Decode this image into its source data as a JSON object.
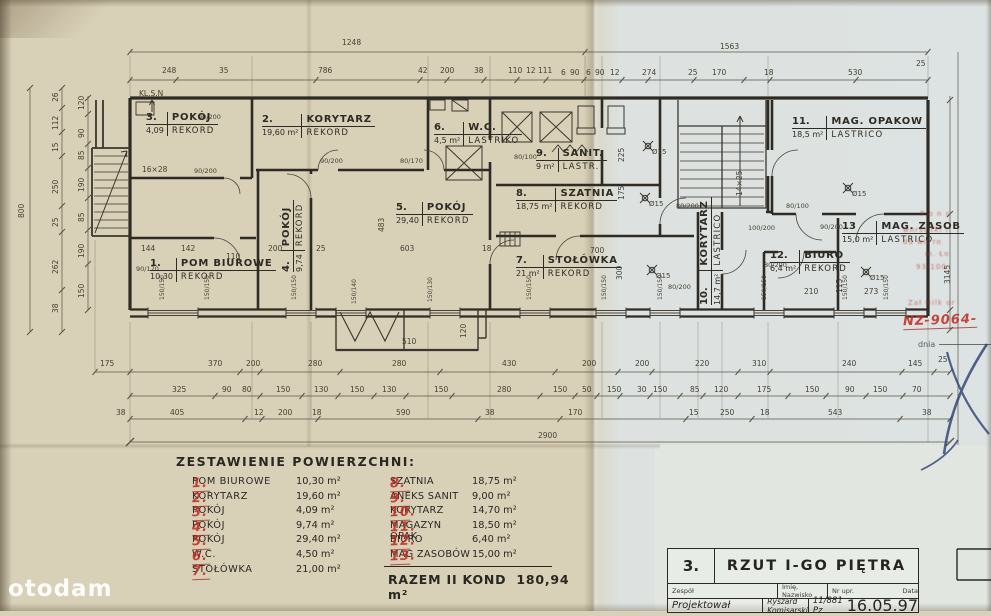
{
  "watermark": "otodam",
  "colors": {
    "paper_left": "#d9d0b8",
    "paper_right": "#dde3e2",
    "ink": "#2e2b25",
    "dim_ink": "#55514a",
    "stamp_red": "#b23426",
    "pen_blue": "#2e3f72"
  },
  "plan": {
    "rooms": [
      {
        "num": "1.",
        "name": "POM BIUROWE",
        "area": "10,30",
        "floor": "REKORD",
        "x": 150,
        "y": 258
      },
      {
        "num": "2.",
        "name": "KORYTARZ",
        "area": "19,60 m²",
        "floor": "REKORD",
        "x": 262,
        "y": 114
      },
      {
        "num": "3.",
        "name": "POKÓJ",
        "area": "4,09",
        "floor": "REKORD",
        "x": 146,
        "y": 112
      },
      {
        "num": "4.",
        "name": "POKÓJ",
        "area": "9,74",
        "floor": "REKORD",
        "x": 281,
        "y": 272,
        "c": "vert"
      },
      {
        "num": "5.",
        "name": "POKÓJ",
        "area": "29,40",
        "floor": "REKORD",
        "x": 396,
        "y": 202
      },
      {
        "num": "6.",
        "name": "W.C.",
        "area": "4,5 m²",
        "floor": "LASTRIKO",
        "x": 434,
        "y": 122
      },
      {
        "num": "7.",
        "name": "STOŁÓWKA",
        "area": "21 m²",
        "floor": "REKORD",
        "x": 516,
        "y": 255
      },
      {
        "num": "8.",
        "name": "SZATNIA",
        "area": "18,75 m²",
        "floor": "REKORD",
        "x": 516,
        "y": 188
      },
      {
        "num": "9.",
        "name": "SANIT.",
        "area": "9 m²",
        "floor": "LASTR.",
        "x": 536,
        "y": 148
      },
      {
        "num": "10.",
        "name": "KORYTARZ",
        "area": "14,7 m²",
        "floor": "LASTRICO",
        "x": 699,
        "y": 305,
        "c": "vert"
      },
      {
        "num": "11.",
        "name": "MAG. OPAKOW",
        "area": "18,5 m²",
        "floor": "LASTRICO",
        "x": 792,
        "y": 116
      },
      {
        "num": "12.",
        "name": "BIURO",
        "area": "6,4 m²",
        "floor": "REKORD",
        "x": 770,
        "y": 250
      },
      {
        "num": "13",
        "name": "MAG. ZASOB",
        "area": "15,0 m²",
        "floor": "LASTRICO",
        "x": 842,
        "y": 221
      }
    ],
    "annotations": [
      {
        "t": "1248",
        "x": 342,
        "y": 39,
        "c": "d"
      },
      {
        "t": "1563",
        "x": 720,
        "y": 43,
        "c": "d"
      },
      {
        "t": "248",
        "x": 162,
        "y": 67,
        "c": "d"
      },
      {
        "t": "35",
        "x": 219,
        "y": 67,
        "c": "d"
      },
      {
        "t": "786",
        "x": 318,
        "y": 67,
        "c": "d"
      },
      {
        "t": "42",
        "x": 418,
        "y": 67,
        "c": "d"
      },
      {
        "t": "200",
        "x": 440,
        "y": 67,
        "c": "d"
      },
      {
        "t": "38",
        "x": 474,
        "y": 67,
        "c": "d"
      },
      {
        "t": "110",
        "x": 508,
        "y": 67,
        "c": "d"
      },
      {
        "t": "12",
        "x": 526,
        "y": 67,
        "c": "d"
      },
      {
        "t": "111",
        "x": 538,
        "y": 67,
        "c": "d"
      },
      {
        "t": "6",
        "x": 561,
        "y": 69,
        "c": "d"
      },
      {
        "t": "90",
        "x": 570,
        "y": 69,
        "c": "d"
      },
      {
        "t": "6",
        "x": 586,
        "y": 69,
        "c": "d"
      },
      {
        "t": "90",
        "x": 595,
        "y": 69,
        "c": "d"
      },
      {
        "t": "12",
        "x": 610,
        "y": 69,
        "c": "d"
      },
      {
        "t": "274",
        "x": 642,
        "y": 69,
        "c": "d"
      },
      {
        "t": "25",
        "x": 688,
        "y": 69,
        "c": "d"
      },
      {
        "t": "170",
        "x": 712,
        "y": 69,
        "c": "d"
      },
      {
        "t": "18",
        "x": 764,
        "y": 69,
        "c": "d"
      },
      {
        "t": "530",
        "x": 848,
        "y": 69,
        "c": "d"
      },
      {
        "t": "25",
        "x": 916,
        "y": 60,
        "c": "d"
      },
      {
        "t": "800",
        "x": 18,
        "y": 218,
        "c": "r"
      },
      {
        "t": "26",
        "x": 52,
        "y": 102,
        "c": "r"
      },
      {
        "t": "112",
        "x": 52,
        "y": 130,
        "c": "r"
      },
      {
        "t": "15",
        "x": 52,
        "y": 152,
        "c": "r"
      },
      {
        "t": "250",
        "x": 52,
        "y": 194,
        "c": "r"
      },
      {
        "t": "25",
        "x": 52,
        "y": 227,
        "c": "r"
      },
      {
        "t": "262",
        "x": 52,
        "y": 274,
        "c": "r"
      },
      {
        "t": "38",
        "x": 52,
        "y": 313,
        "c": "r"
      },
      {
        "t": "120",
        "x": 78,
        "y": 110,
        "c": "r"
      },
      {
        "t": "90",
        "x": 78,
        "y": 138,
        "c": "r"
      },
      {
        "t": "85",
        "x": 78,
        "y": 160,
        "c": "r"
      },
      {
        "t": "190",
        "x": 78,
        "y": 192,
        "c": "r"
      },
      {
        "t": "85",
        "x": 78,
        "y": 222,
        "c": "r"
      },
      {
        "t": "190",
        "x": 78,
        "y": 258,
        "c": "r"
      },
      {
        "t": "150",
        "x": 78,
        "y": 298,
        "c": "r"
      },
      {
        "t": "175",
        "x": 100,
        "y": 360,
        "c": "d"
      },
      {
        "t": "370",
        "x": 208,
        "y": 360,
        "c": "d"
      },
      {
        "t": "200",
        "x": 246,
        "y": 360,
        "c": "d"
      },
      {
        "t": "280",
        "x": 308,
        "y": 360,
        "c": "d"
      },
      {
        "t": "280",
        "x": 392,
        "y": 360,
        "c": "d"
      },
      {
        "t": "430",
        "x": 502,
        "y": 360,
        "c": "d"
      },
      {
        "t": "200",
        "x": 582,
        "y": 360,
        "c": "d"
      },
      {
        "t": "200",
        "x": 635,
        "y": 360,
        "c": "d"
      },
      {
        "t": "220",
        "x": 695,
        "y": 360,
        "c": "d"
      },
      {
        "t": "310",
        "x": 752,
        "y": 360,
        "c": "d"
      },
      {
        "t": "240",
        "x": 842,
        "y": 360,
        "c": "d"
      },
      {
        "t": "145",
        "x": 908,
        "y": 360,
        "c": "d"
      },
      {
        "t": "25",
        "x": 938,
        "y": 356,
        "c": "d"
      },
      {
        "t": "325",
        "x": 172,
        "y": 386,
        "c": "d"
      },
      {
        "t": "90",
        "x": 222,
        "y": 386,
        "c": "d"
      },
      {
        "t": "80",
        "x": 242,
        "y": 386,
        "c": "d"
      },
      {
        "t": "150",
        "x": 276,
        "y": 386,
        "c": "d"
      },
      {
        "t": "130",
        "x": 314,
        "y": 386,
        "c": "d"
      },
      {
        "t": "150",
        "x": 350,
        "y": 386,
        "c": "d"
      },
      {
        "t": "130",
        "x": 382,
        "y": 386,
        "c": "d"
      },
      {
        "t": "150",
        "x": 434,
        "y": 386,
        "c": "d"
      },
      {
        "t": "280",
        "x": 497,
        "y": 386,
        "c": "d"
      },
      {
        "t": "150",
        "x": 553,
        "y": 386,
        "c": "d"
      },
      {
        "t": "50",
        "x": 582,
        "y": 386,
        "c": "d"
      },
      {
        "t": "150",
        "x": 607,
        "y": 386,
        "c": "d"
      },
      {
        "t": "30",
        "x": 637,
        "y": 386,
        "c": "d"
      },
      {
        "t": "150",
        "x": 653,
        "y": 386,
        "c": "d"
      },
      {
        "t": "85",
        "x": 690,
        "y": 386,
        "c": "d"
      },
      {
        "t": "120",
        "x": 714,
        "y": 386,
        "c": "d"
      },
      {
        "t": "175",
        "x": 757,
        "y": 386,
        "c": "d"
      },
      {
        "t": "150",
        "x": 805,
        "y": 386,
        "c": "d"
      },
      {
        "t": "90",
        "x": 845,
        "y": 386,
        "c": "d"
      },
      {
        "t": "150",
        "x": 873,
        "y": 386,
        "c": "d"
      },
      {
        "t": "70",
        "x": 912,
        "y": 386,
        "c": "d"
      },
      {
        "t": "38",
        "x": 116,
        "y": 409,
        "c": "d"
      },
      {
        "t": "405",
        "x": 170,
        "y": 409,
        "c": "d"
      },
      {
        "t": "12",
        "x": 254,
        "y": 409,
        "c": "d"
      },
      {
        "t": "200",
        "x": 278,
        "y": 409,
        "c": "d"
      },
      {
        "t": "18",
        "x": 312,
        "y": 409,
        "c": "d"
      },
      {
        "t": "590",
        "x": 396,
        "y": 409,
        "c": "d"
      },
      {
        "t": "38",
        "x": 485,
        "y": 409,
        "c": "d"
      },
      {
        "t": "170",
        "x": 568,
        "y": 409,
        "c": "d"
      },
      {
        "t": "15",
        "x": 689,
        "y": 409,
        "c": "d"
      },
      {
        "t": "250",
        "x": 720,
        "y": 409,
        "c": "d"
      },
      {
        "t": "18",
        "x": 760,
        "y": 409,
        "c": "d"
      },
      {
        "t": "543",
        "x": 828,
        "y": 409,
        "c": "d"
      },
      {
        "t": "38",
        "x": 922,
        "y": 409,
        "c": "d"
      },
      {
        "t": "2900",
        "x": 538,
        "y": 432,
        "c": "d"
      },
      {
        "t": "144",
        "x": 141,
        "y": 245,
        "c": "d"
      },
      {
        "t": "142",
        "x": 181,
        "y": 245,
        "c": "d"
      },
      {
        "t": "110",
        "x": 226,
        "y": 253,
        "c": "d"
      },
      {
        "t": "200",
        "x": 268,
        "y": 245,
        "c": "d"
      },
      {
        "t": "25",
        "x": 316,
        "y": 245,
        "c": "d"
      },
      {
        "t": "603",
        "x": 400,
        "y": 245,
        "c": "d"
      },
      {
        "t": "18",
        "x": 482,
        "y": 245,
        "c": "d"
      },
      {
        "t": "483",
        "x": 378,
        "y": 232,
        "c": "r"
      },
      {
        "t": "700",
        "x": 590,
        "y": 247,
        "c": "d"
      },
      {
        "t": "300",
        "x": 616,
        "y": 280,
        "c": "r"
      },
      {
        "t": "225",
        "x": 618,
        "y": 162,
        "c": "r"
      },
      {
        "t": "175",
        "x": 618,
        "y": 200,
        "c": "r"
      },
      {
        "t": "210",
        "x": 804,
        "y": 288,
        "c": "d"
      },
      {
        "t": "273",
        "x": 864,
        "y": 288,
        "c": "d"
      },
      {
        "t": "115",
        "x": 836,
        "y": 293,
        "c": "r"
      },
      {
        "t": "510",
        "x": 402,
        "y": 338,
        "c": "d"
      },
      {
        "t": "120",
        "x": 460,
        "y": 338,
        "c": "r"
      },
      {
        "t": "16×28",
        "x": 142,
        "y": 166,
        "c": "d"
      },
      {
        "t": "14×25",
        "x": 736,
        "y": 196,
        "c": "r"
      },
      {
        "t": "3145",
        "x": 944,
        "y": 284,
        "c": "r"
      },
      {
        "t": "KL.S.N",
        "x": 139,
        "y": 90,
        "c": "d"
      },
      {
        "t": "90/200",
        "x": 198,
        "y": 114,
        "c": "dr"
      },
      {
        "t": "90/200",
        "x": 194,
        "y": 168,
        "c": "dr"
      },
      {
        "t": "90/170",
        "x": 136,
        "y": 266,
        "c": "dr"
      },
      {
        "t": "90/200",
        "x": 320,
        "y": 158,
        "c": "dr"
      },
      {
        "t": "80/170",
        "x": 400,
        "y": 158,
        "c": "dr"
      },
      {
        "t": "80/100",
        "x": 514,
        "y": 154,
        "c": "dr"
      },
      {
        "t": "80/200",
        "x": 676,
        "y": 203,
        "c": "dr"
      },
      {
        "t": "80/200",
        "x": 668,
        "y": 284,
        "c": "dr"
      },
      {
        "t": "100/200",
        "x": 748,
        "y": 225,
        "c": "dr"
      },
      {
        "t": "90/200",
        "x": 820,
        "y": 224,
        "c": "dr"
      },
      {
        "t": "80/200",
        "x": 764,
        "y": 262,
        "c": "dr"
      },
      {
        "t": "80/100",
        "x": 786,
        "y": 203,
        "c": "dr"
      },
      {
        "t": "150/150",
        "x": 160,
        "y": 300,
        "c": "rr"
      },
      {
        "t": "150/150",
        "x": 205,
        "y": 300,
        "c": "rr"
      },
      {
        "t": "150/150",
        "x": 292,
        "y": 300,
        "c": "rr"
      },
      {
        "t": "150/140",
        "x": 352,
        "y": 304,
        "c": "rr"
      },
      {
        "t": "150/130",
        "x": 428,
        "y": 302,
        "c": "rr"
      },
      {
        "t": "150/150",
        "x": 527,
        "y": 300,
        "c": "rr"
      },
      {
        "t": "150/150",
        "x": 602,
        "y": 300,
        "c": "rr"
      },
      {
        "t": "150/150",
        "x": 658,
        "y": 300,
        "c": "rr"
      },
      {
        "t": "150/150",
        "x": 762,
        "y": 300,
        "c": "rr"
      },
      {
        "t": "150/150",
        "x": 843,
        "y": 300,
        "c": "rr"
      },
      {
        "t": "150/150",
        "x": 884,
        "y": 300,
        "c": "rr"
      },
      {
        "t": "Ø15",
        "x": 652,
        "y": 149,
        "c": "p"
      },
      {
        "t": "Ø15",
        "x": 649,
        "y": 201,
        "c": "p"
      },
      {
        "t": "Ø15",
        "x": 656,
        "y": 273,
        "c": "p"
      },
      {
        "t": "Ø15",
        "x": 852,
        "y": 191,
        "c": "p"
      },
      {
        "t": "Ø15",
        "x": 870,
        "y": 275,
        "c": "p"
      }
    ]
  },
  "summary": {
    "title": "ZESTAWIENIE POWIERZCHNI:",
    "col1": [
      {
        "num": "1.",
        "name": "POM BIUROWE",
        "area": "10,30 m²"
      },
      {
        "num": "2.",
        "name": "KORYTARZ",
        "area": "19,60 m²"
      },
      {
        "num": "3.",
        "name": "POKÓJ",
        "area": "4,09 m²"
      },
      {
        "num": "4.",
        "name": "POKÓJ",
        "area": "9,74 m²"
      },
      {
        "num": "5.",
        "name": "POKÓJ",
        "area": "29,40 m²"
      },
      {
        "num": "6.",
        "name": "W.C.",
        "area": "4,50 m²"
      },
      {
        "num": "7.",
        "name": "STOŁÓWKA",
        "area": "21,00 m²"
      }
    ],
    "col2": [
      {
        "num": "8.",
        "name": "SZATNIA",
        "area": "18,75 m²"
      },
      {
        "num": "9.",
        "name": "ANEKS SANIT",
        "area": "9,00 m²"
      },
      {
        "num": "10.",
        "name": "KORYTARZ",
        "area": "14,70 m²"
      },
      {
        "num": "11.",
        "name": "MAGAZYN OPAK",
        "area": "18,50 m²"
      },
      {
        "num": "12.",
        "name": "BIURO",
        "area": "6,40 m²"
      },
      {
        "num": "13.",
        "name": "MAG ZASOBÓW",
        "area": "15,00 m²"
      }
    ],
    "total_label": "RAZEM II KOND",
    "total_value": "180,94 m²"
  },
  "title_block": {
    "number": "3.",
    "title": "RZUT I-GO PIĘTRA",
    "headers": [
      {
        "t": "Zespół"
      },
      {
        "t": "Imię, Nazwisko"
      },
      {
        "t": "Nr upr."
      },
      {
        "t": "Data"
      }
    ],
    "values": [
      {
        "t": "Projektował"
      },
      {
        "t": "Ryszard Komisarski"
      },
      {
        "t": "11/881 Pz"
      },
      {
        "t": "16.05.97"
      }
    ]
  },
  "stamp": {
    "fragments": [
      {
        "t": "P o n s",
        "x": 920,
        "y": 210
      },
      {
        "t": "wnrst tki i",
        "x": 903,
        "y": 226
      },
      {
        "t": "da  wil ro",
        "x": 903,
        "y": 238
      },
      {
        "t": "m.  Ło",
        "x": 925,
        "y": 250
      },
      {
        "t": "93-100",
        "x": 916,
        "y": 263
      },
      {
        "t": "Zał   wilk  or",
        "x": 908,
        "y": 299
      }
    ],
    "number": "NZ-9064-",
    "dnia": "dnia"
  }
}
